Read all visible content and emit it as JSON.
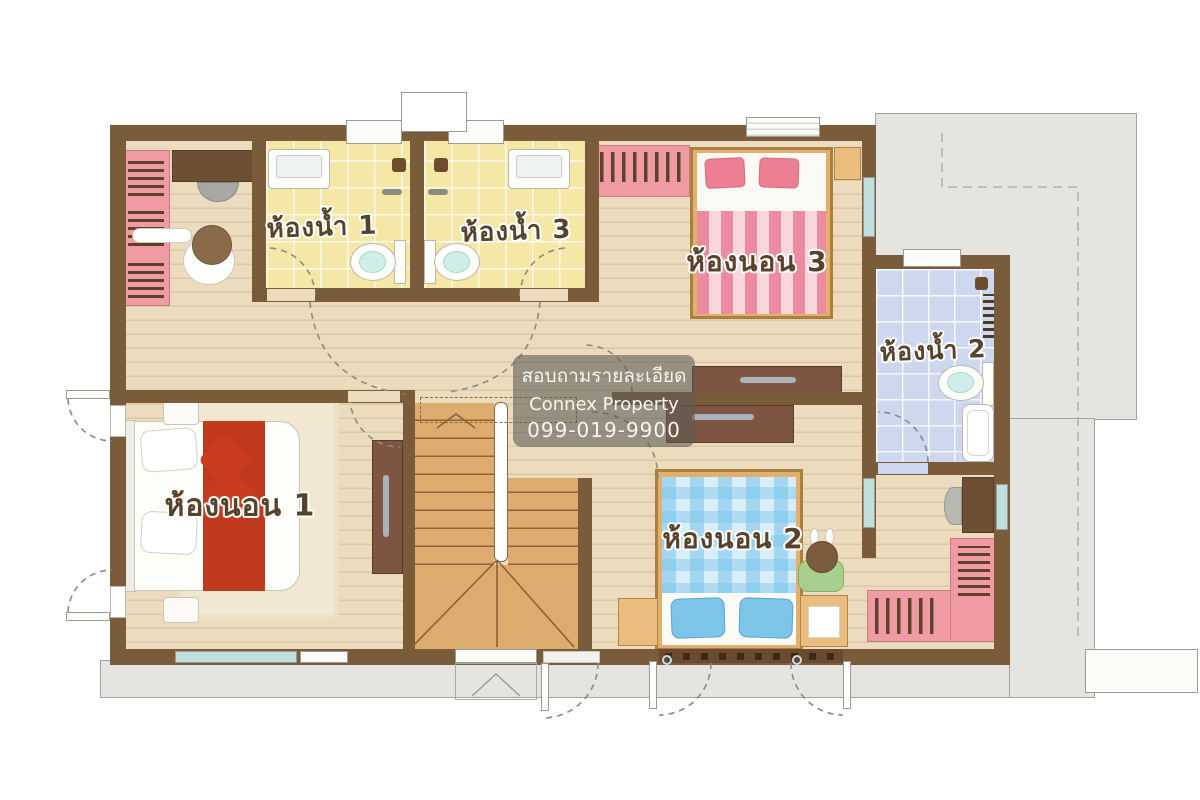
{
  "rooms": {
    "bathroom1": {
      "label": "ห้องน้ำ 1"
    },
    "bathroom3": {
      "label": "ห้องน้ำ 3"
    },
    "bedroom3": {
      "label": "ห้องนอน 3"
    },
    "bathroom2": {
      "label": "ห้องน้ำ 2"
    },
    "bedroom1": {
      "label": "ห้องนอน 1"
    },
    "bedroom2": {
      "label": "ห้องนอน 2"
    }
  },
  "watermark": {
    "line1": "สอบถามรายละเอียด",
    "line2": "Connex Property",
    "line3": "099-019-9900"
  },
  "colors": {
    "wall": "#7a5b3a",
    "wood_floor": "#ecdbbd",
    "bathroom_yellow": "#f5e7a6",
    "bathroom_blue": "#cdd8ee",
    "roof_gray": "#e4e5e1",
    "furniture_pink": "#f09aa3",
    "bed1_red": "#c23a1d",
    "bed2_blue": "#7cc4e8",
    "bed3_pink": "#ec8ba0",
    "stair_wood": "#dcab6d"
  }
}
